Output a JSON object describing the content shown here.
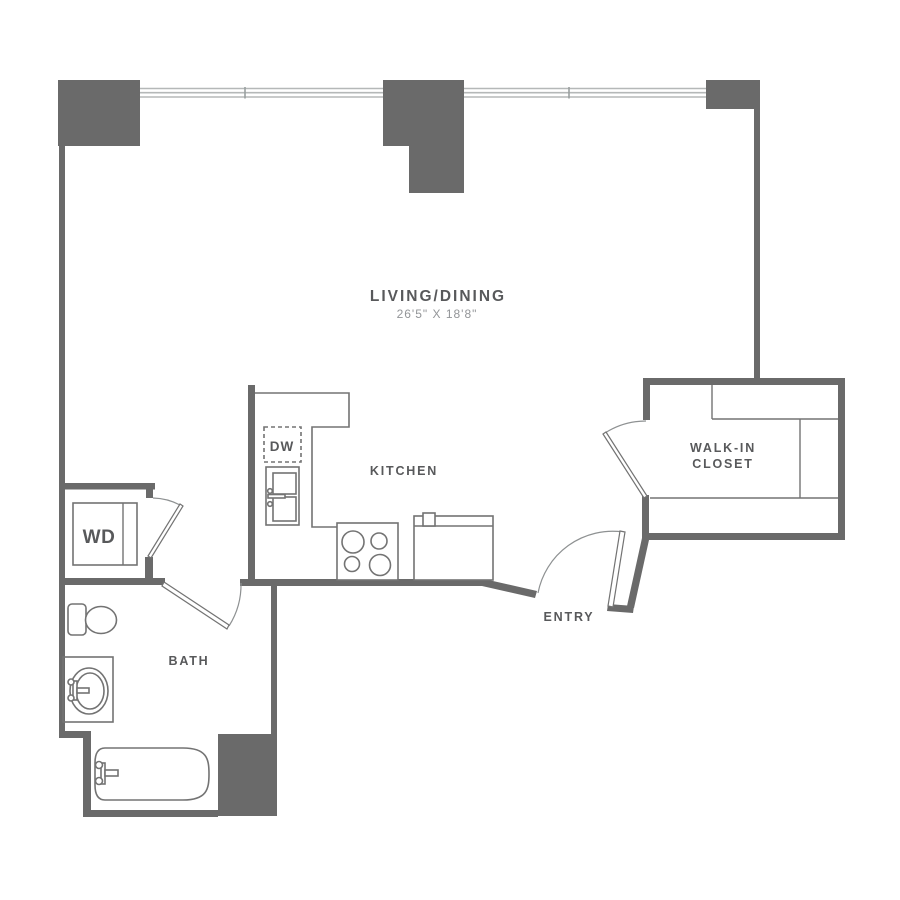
{
  "plan": {
    "rooms": {
      "living_dining": {
        "label": "LIVING/DINING",
        "dimensions": "26'5\" X 18'8\""
      },
      "kitchen": {
        "label": "KITCHEN"
      },
      "walk_in_closet": {
        "label_line1": "WALK-IN",
        "label_line2": "CLOSET"
      },
      "entry": {
        "label": "ENTRY"
      },
      "bath": {
        "label": "BATH"
      }
    },
    "appliances": {
      "washer_dryer": {
        "label": "WD"
      },
      "dishwasher": {
        "label": "DW"
      }
    },
    "colors": {
      "background": "#ffffff",
      "wall": "#6a6a6a",
      "fixture_stroke": "#737373",
      "door_arc": "#8e9192",
      "window": "#b5b8b8",
      "window_mullion": "#9aa0a0",
      "label_text": "#58595b",
      "dimension_text": "#939598"
    }
  }
}
